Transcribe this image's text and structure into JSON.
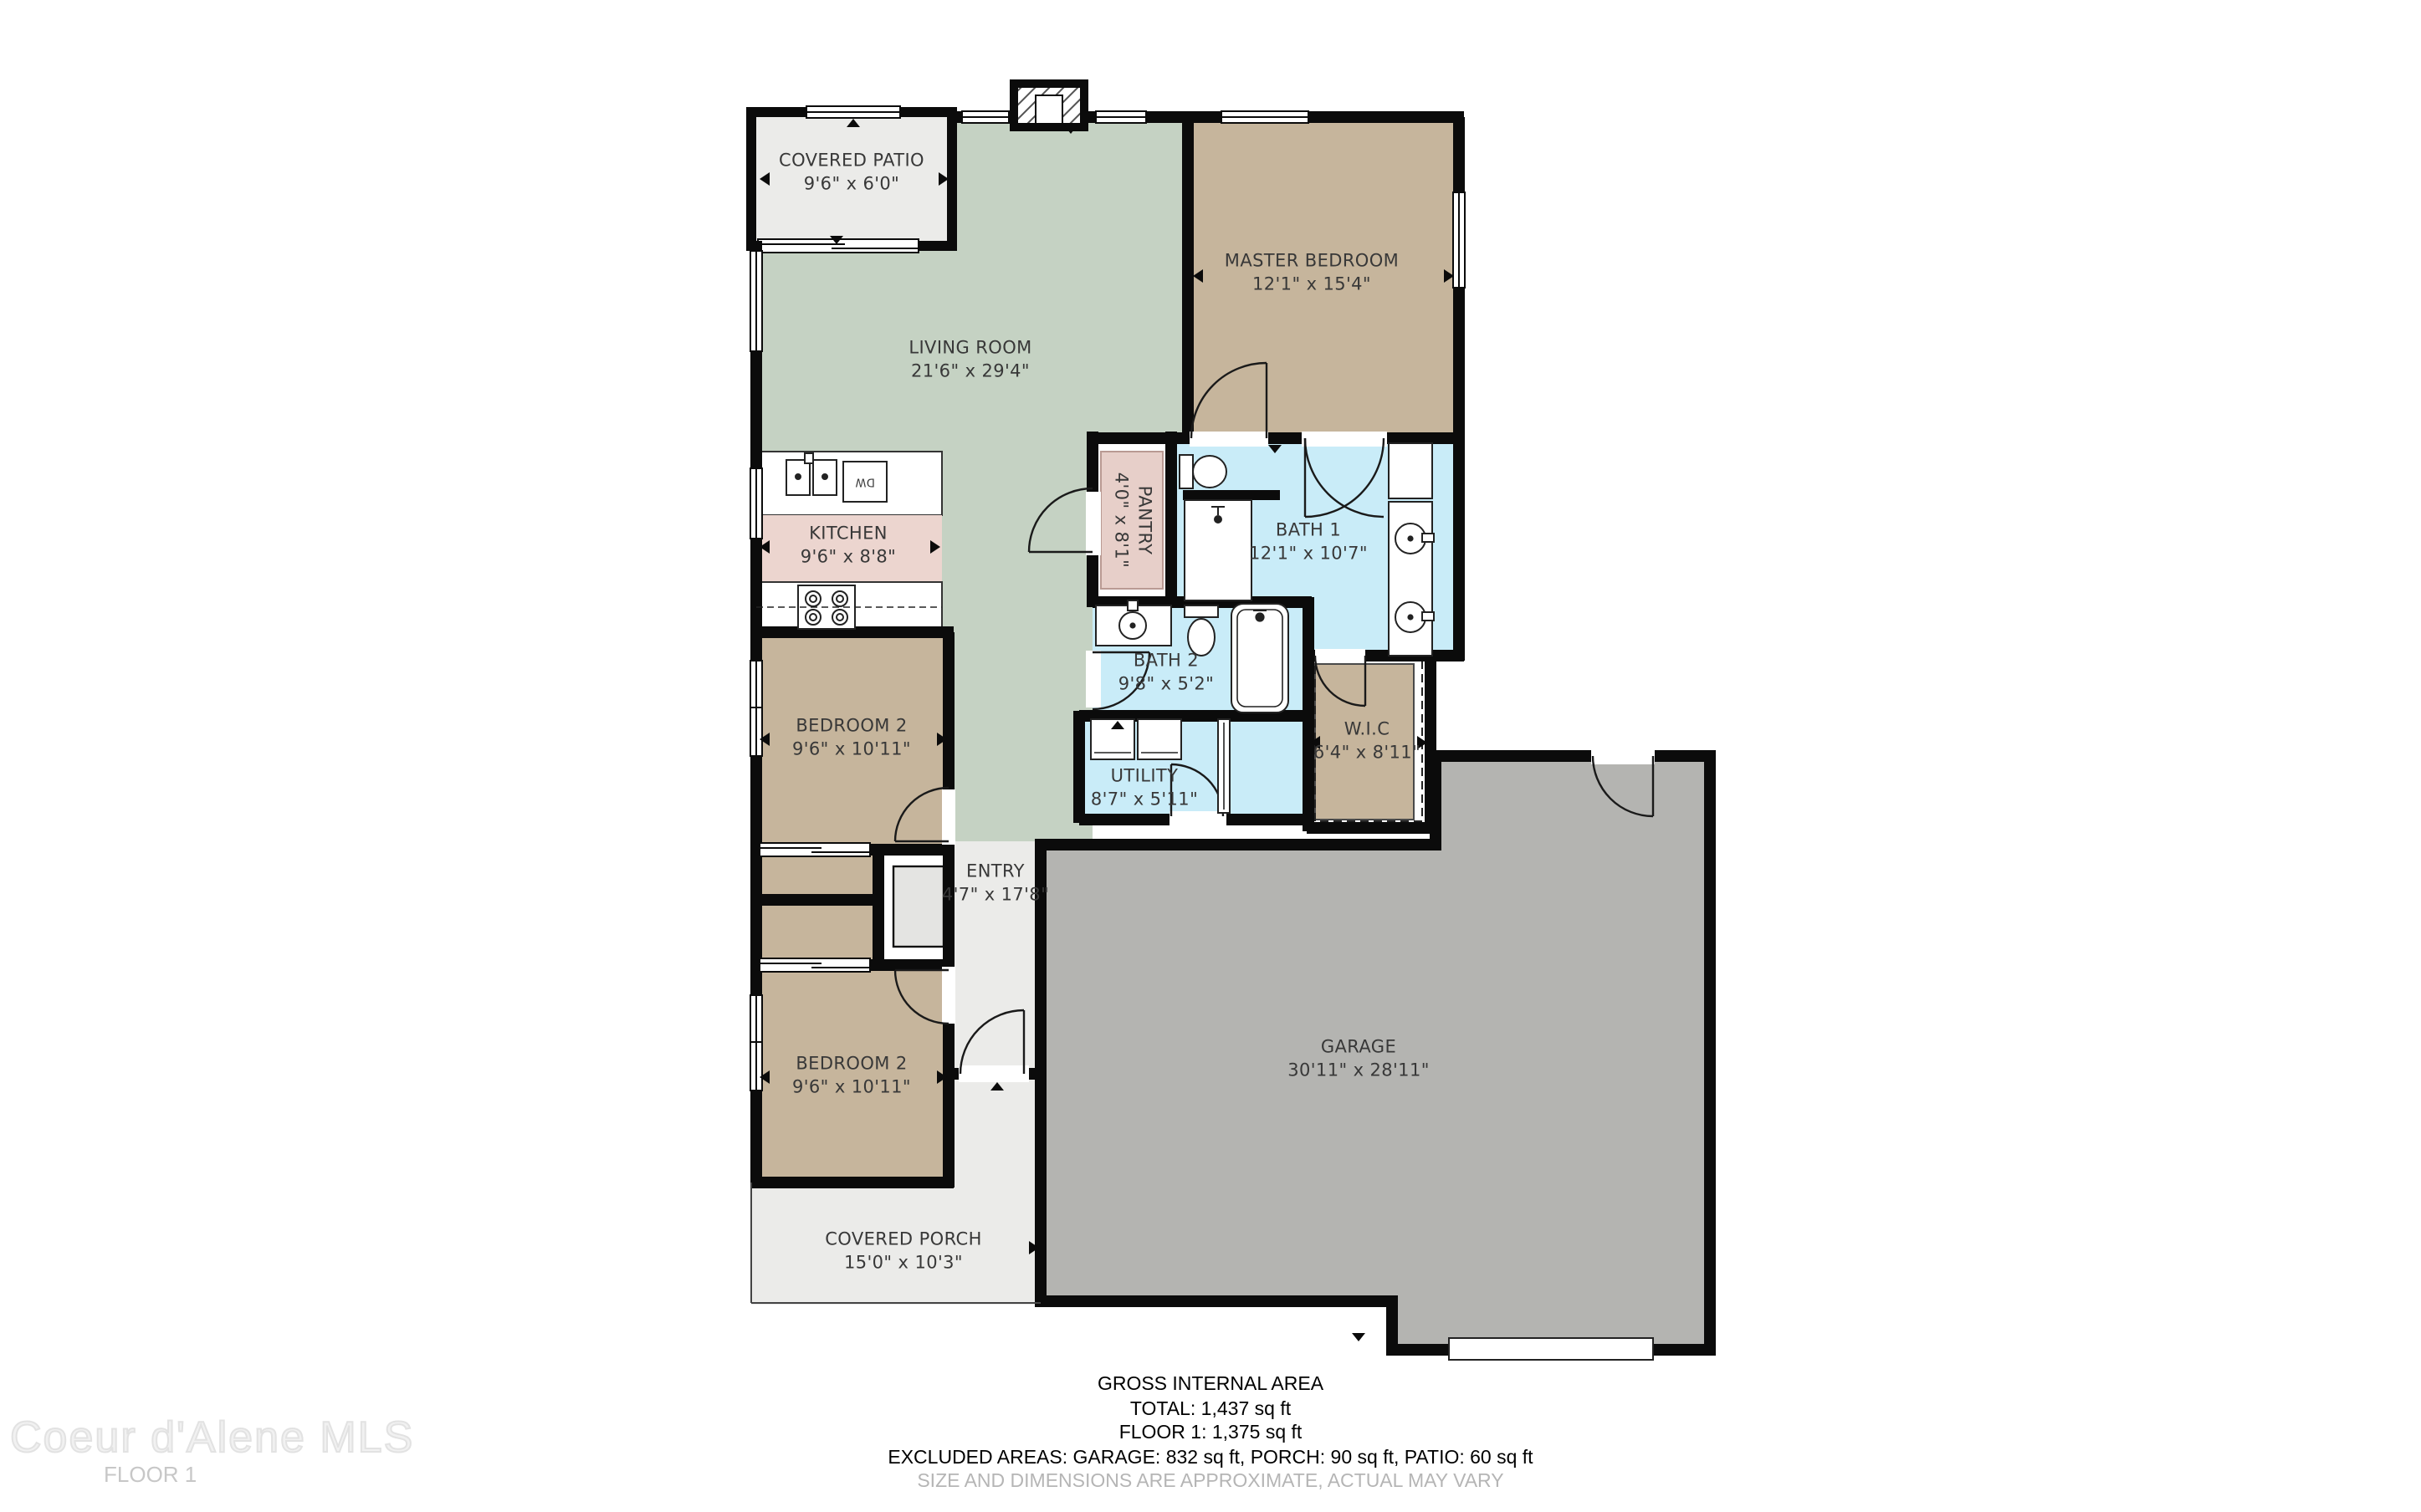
{
  "plan": {
    "rooms": {
      "covered_patio": {
        "name": "COVERED PATIO",
        "dims": "9'6\" x 6'0\""
      },
      "living_room": {
        "name": "LIVING ROOM",
        "dims": "21'6\" x 29'4\""
      },
      "master_bedroom": {
        "name": "MASTER BEDROOM",
        "dims": "12'1\" x 15'4\""
      },
      "kitchen": {
        "name": "KITCHEN",
        "dims": "9'6\" x 8'8\""
      },
      "pantry": {
        "name": "PANTRY",
        "dims": "4'0\" x 8'1\""
      },
      "bath_1": {
        "name": "BATH 1",
        "dims": "12'1\" x 10'7\""
      },
      "bath_2": {
        "name": "BATH 2",
        "dims": "9'8\" x 5'2\""
      },
      "wic": {
        "name": "W.I.C",
        "dims": "6'4\" x 8'11\""
      },
      "utility": {
        "name": "UTILITY",
        "dims": "8'7\" x 5'11\""
      },
      "bedroom_2_upper": {
        "name": "BEDROOM 2",
        "dims": "9'6\" x 10'11\""
      },
      "bedroom_2_lower": {
        "name": "BEDROOM 2",
        "dims": "9'6\" x 10'11\""
      },
      "entry": {
        "name": "ENTRY",
        "dims": "4'7\" x 17'8\""
      },
      "garage": {
        "name": "GARAGE",
        "dims": "30'11\" x 28'11\""
      },
      "covered_porch": {
        "name": "COVERED PORCH",
        "dims": "15'0\" x 10'3\""
      }
    },
    "fixtures": {
      "dishwasher": "DW"
    }
  },
  "footer": {
    "line1": "GROSS INTERNAL AREA",
    "line2": "TOTAL: 1,437 sq ft",
    "line3": "FLOOR 1: 1,375 sq ft",
    "line4": "EXCLUDED AREAS: GARAGE: 832 sq ft, PORCH: 90 sq ft, PATIO: 60 sq ft",
    "line5": "SIZE AND DIMENSIONS ARE APPROXIMATE, ACTUAL MAY VARY"
  },
  "watermark": {
    "brand": "Coeur d'Alene MLS",
    "floor": "FLOOR 1"
  },
  "colors": {
    "living": "#c5d2c3",
    "bedroom": "#c6b59c",
    "kitchen": "#ecd5cf",
    "pantry_rug": "#e7cfc9",
    "bath": "#c9ecf8",
    "garage": "#b4b4b1",
    "outdoor": "#ebebe9",
    "wall": "#0b0b0b"
  }
}
